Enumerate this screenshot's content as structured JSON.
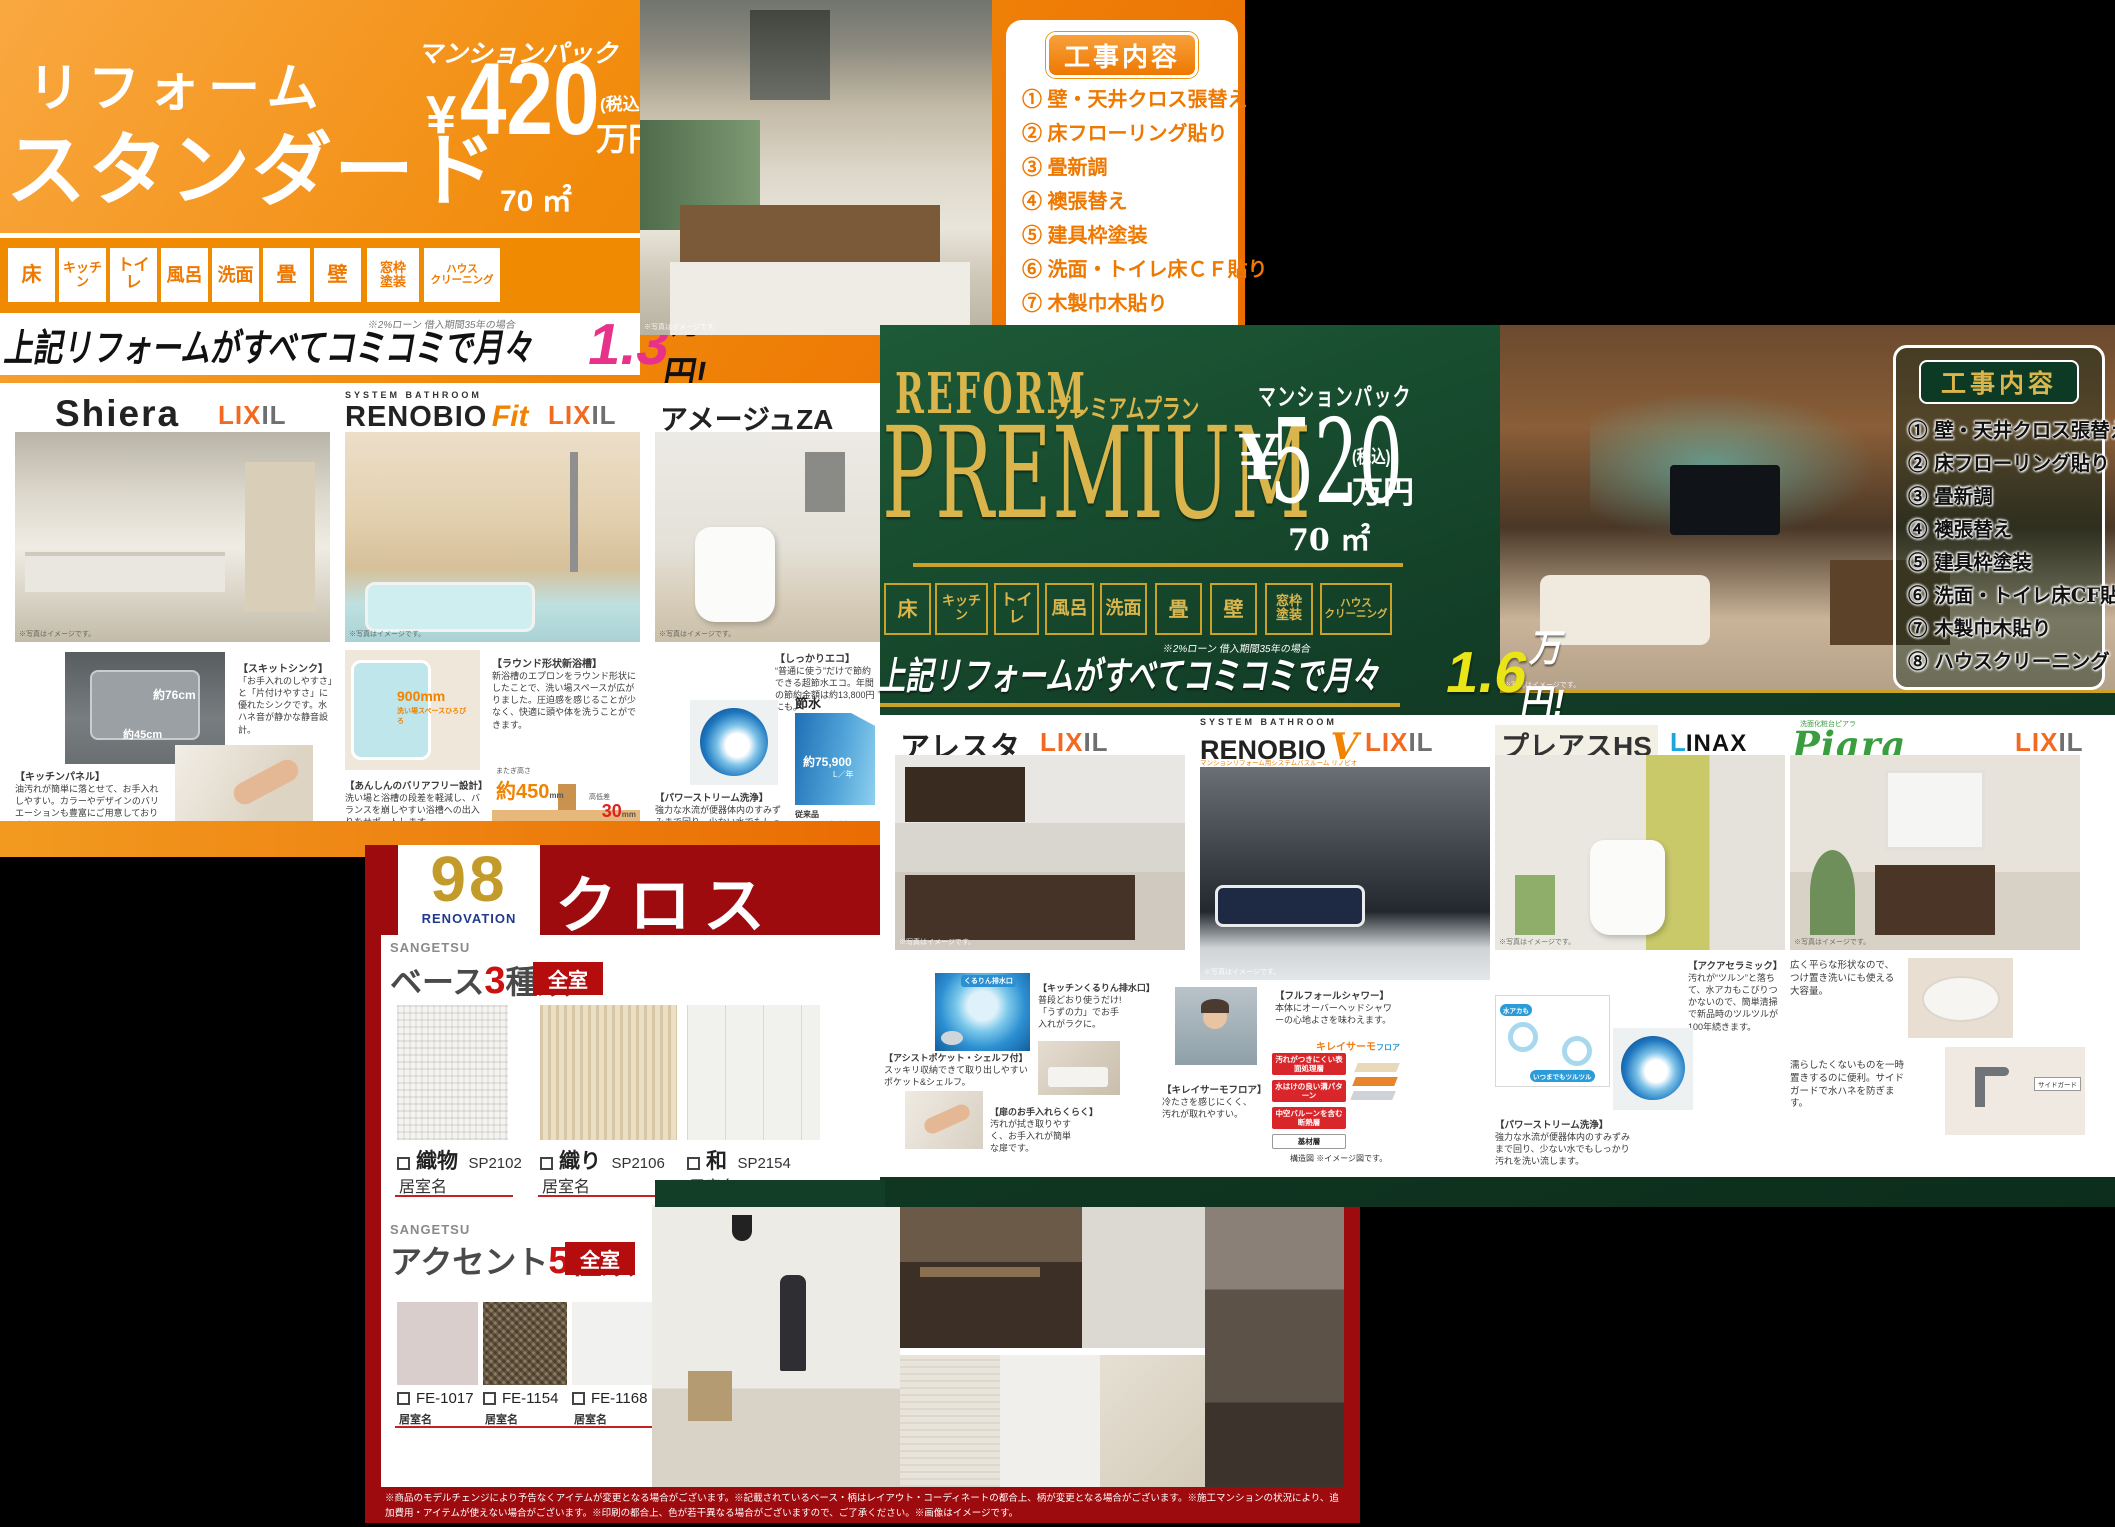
{
  "colors": {
    "orange": "#ee7800",
    "orange_deep": "#ea6c02",
    "magenta": "#e7318a",
    "green_dark": "#123d26",
    "gold": "#d9b54c",
    "yellow": "#e9e516",
    "red_dark": "#9e0b0f",
    "lixil_orange": "#f26a21",
    "inax_blue": "#1ba7dc"
  },
  "shared": {
    "photo_note": "※写真はイメージです。"
  },
  "standard": {
    "title1": "リフォーム",
    "title2": "スタンダード",
    "pack": "マンションパック",
    "yen": "¥",
    "price": "420",
    "tax": "(税込)",
    "unit": "万円",
    "area": "70 ㎡",
    "tabs": [
      "床",
      "キッチン",
      "トイレ",
      "風呂",
      "洗面",
      "畳",
      "壁",
      "窓枠\n塗装",
      "ハウス\nクリーニング"
    ],
    "banner": {
      "note": "※2%ローン 借入期間35年の場合",
      "pre": "上記リフォームがすべてコミコミで月々",
      "big": "1.3",
      "post": "万円!"
    },
    "koji": {
      "title": "工事内容",
      "items": [
        "① 壁・天井クロス張替え",
        "② 床フローリング貼り",
        "③ 畳新調",
        "④ 襖張替え",
        "⑤ 建具枠塗装",
        "⑥ 洗面・トイレ床ＣＦ貼り",
        "⑦ 木製巾木貼り",
        "⑧ ハウスクリーニング"
      ]
    },
    "shiera": {
      "name": "Shiera",
      "brand_a": "LIX",
      "brand_b": "IL",
      "dim_w": "約76cm",
      "dim_d": "約45cm",
      "cap1_title": "【スキットシンク】",
      "cap1_body": "「お手入れのしやすさ」と「片付けやすさ」に優れたシンクです。水ハネ音が静かな静音設計。",
      "cap2_title": "【キッチンパネル】",
      "cap2_body": "油汚れが簡単に落とせて、お手入れしやすい。カラーやデザインのバリエーションも豊富にご用意しております。"
    },
    "renobio": {
      "kicker": "SYSTEM BATHROOM",
      "name": "RENOBIO",
      "accent": "Fit",
      "brand_a": "LIX",
      "brand_b": "IL",
      "bath_label": "900mm",
      "bath_sub": "洗い場スペースひろびろ",
      "cap1_title": "【ラウンド形状新浴槽】",
      "cap1_body": "新浴槽のエプロンをラウンド形状にしたことで、洗い場スペースが広がりました。圧迫感を感じることが少なく、快適に頭や体を洗うことができます。",
      "cap2_title": "【あんしんのバリアフリー設計】",
      "cap2_body": "洗い場と浴槽の段差を軽減し、バランスを崩しやすい浴槽への出入りをサポートします。",
      "step_l1": "またぎ高さ",
      "step_v1": "約450",
      "step_u1": "mm",
      "step_l2": "高低差",
      "step_v2": "30",
      "step_u2": "mm"
    },
    "amage": {
      "name": "アメージュZA",
      "cap1_title": "【しっかりエコ】",
      "cap1_body": "“普通に使う”だけで節約できる超節水エコ。年間の節約金額は約13,800円にも。",
      "cap2_title": "【パワーストリーム洗浄】",
      "cap2_body": "強力な水流が便器体内のすみずみまで回り、少ない水でもしっかり汚れを洗い流します。",
      "save_label": "節水",
      "save_value": "約75,900",
      "save_unit": "L／年",
      "save_base": "従来品",
      "save_note": "(1989~2001年発売品)",
      "save_spec": "【大13L】"
    }
  },
  "premium": {
    "reform": "REFORM",
    "plan": "プレミアムプラン",
    "name": "PREMIUM",
    "pack": "マンションパック",
    "yen": "¥",
    "price": "520",
    "tax": "(税込)",
    "unit": "万円",
    "area": "70 ㎡",
    "tabs": [
      "床",
      "キッチン",
      "トイレ",
      "風呂",
      "洗面",
      "畳",
      "壁",
      "窓枠\n塗装",
      "ハウス\nクリーニング"
    ],
    "banner": {
      "note": "※2%ローン 借入期間35年の場合",
      "pre": "上記リフォームがすべてコミコミで月々",
      "big": "1.6",
      "post": "万円!"
    },
    "koji": {
      "title": "工事内容",
      "items": [
        "① 壁・天井クロス張替え",
        "② 床フローリング貼り",
        "③ 畳新調",
        "④ 襖張替え",
        "⑤ 建具枠塗装",
        "⑥ 洗面・トイレ床CF貼り",
        "⑦ 木製巾木貼り",
        "⑧ ハウスクリーニング"
      ]
    },
    "alesta": {
      "name": "アレスタ",
      "brand_a": "LIX",
      "brand_b": "IL",
      "drain_label": "くるりん排水口",
      "cap1_title": "【キッチンくるりん排水口】",
      "cap1_body": "普段どおり使うだけ!「うずの力」でお手入れがラクに。",
      "cap2_title": "【アシストポケット・シェルフ付】",
      "cap2_body": "スッキリ収納できて取り出しやすいポケット&シェルフ。",
      "cap3_title": "【扉のお手入れらくらく】",
      "cap3_body": "汚れが拭き取りやすく、お手入れが簡単な扉です。"
    },
    "renobiov": {
      "kicker": "SYSTEM BATHROOM",
      "name": "RENOBIO",
      "accent": "V",
      "sub": "マンションリフォーム用システムバスルーム リノビオ",
      "brand_a": "LIX",
      "brand_b": "IL",
      "cap1_title": "【フルフォールシャワー】",
      "cap1_body": "本体にオーバーヘッドシャワーの心地よさを味わえます。",
      "cap2_title": "【キレイサーモフロア】",
      "cap2_body": "冷たさを感じにくく、汚れが取れやすい。",
      "logo_a": "キレイサーモ",
      "logo_b": "フロア",
      "layers": [
        "汚れがつきにくい表面処理層",
        "水はけの良い溝パターン",
        "中空バルーンを含む断熱層",
        "基材層"
      ],
      "note": "構造図 ※イメージ図です。"
    },
    "preas": {
      "name": "プレアスHS",
      "brand_mark": "L",
      "brand": "INAX",
      "cap1_title": "【アクアセラミック】",
      "cap1_body": "汚れが“ツルン”と落ちて、水アカもこびりつかないので、簡単清掃で新品時のツルツルが100年続きます。",
      "tag1": "水アカも",
      "tag2": "いつまでもツルツル",
      "cap2_title": "【パワーストリーム洗浄】",
      "cap2_body": "強力な水流が便器体内のすみずみまで回り、少ない水でもしっかり汚れを洗い流します。"
    },
    "piara": {
      "name": "Piara",
      "sub": "洗面化粧台ピアラ",
      "brand_a": "LIX",
      "brand_b": "IL",
      "cap1_body": "広く平らな形状なので、つけ置き洗いにも使える大容量。",
      "cap2_body": "濡らしたくないものを一時置きするのに便利。サイドガードで水ハネを防ぎます。",
      "side_label": "サイドガード"
    }
  },
  "cross": {
    "badge": "98",
    "badge_sub": "RENOVATION",
    "title": "クロス",
    "maker": "SANGETSU",
    "base": {
      "pre": "ベース",
      "num": "3",
      "post": "種類",
      "badge": "全室",
      "room": "居室名",
      "samples": [
        {
          "name": "織物",
          "code": "SP2102"
        },
        {
          "name": "織り",
          "code": "SP2106"
        },
        {
          "name": "和",
          "code": "SP2154"
        }
      ]
    },
    "accent": {
      "pre": "アクセント",
      "num": "5",
      "post": "種類",
      "badge": "全室",
      "room": "居室名",
      "codes": [
        "FE-1017",
        "FE-1154",
        "FE-1168",
        "FE-1173",
        "FE-1549"
      ]
    },
    "fine_print": "※商品のモデルチェンジにより予告なくアイテムが変更となる場合がございます。※記載されているベース・柄はレイアウト・コーディネートの都合上、柄が変更となる場合がございます。※施工マンションの状況により、追加費用・アイテムが使えない場合がございます。※印刷の都合上、色が若干異なる場合がございますので、ご了承ください。※画像はイメージです。"
  }
}
